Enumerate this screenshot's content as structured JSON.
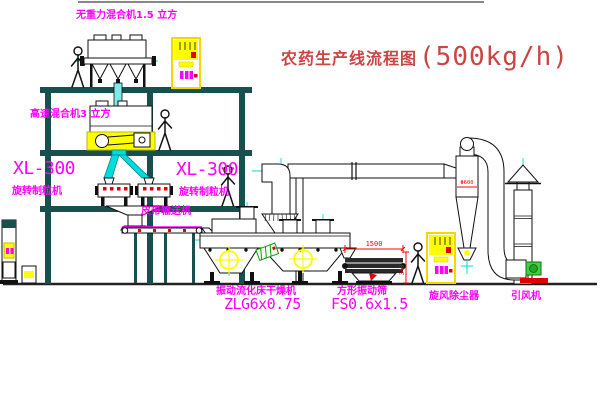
{
  "title": {
    "text": "农药生产线流程图",
    "capacity": "(500kg/h)"
  },
  "labels": {
    "gravity_mixer": "无重力混合机1.5 立方",
    "high_speed_mixer": "高速混合机3 立方",
    "granulator_left": {
      "model": "XL-300",
      "name": "旋转制粒机"
    },
    "granulator_right": {
      "model": "XL-300",
      "name": "旋转制粒机"
    },
    "belt_conveyor": "皮带输送机",
    "dryer": {
      "name": "振动流化床干燥机",
      "model": "ZLG6x0.75"
    },
    "screen": {
      "name": "方形振动筛",
      "model": "FS0.6x1.5"
    },
    "cyclone": "旋风除尘器",
    "fan": "引风机"
  },
  "dimensions": {
    "screen_length": "1500",
    "screen_height": "340",
    "cyclone_diameter": "Φ600"
  },
  "colors": {
    "label_magenta": "#ff00ff",
    "title_red": "#cc4444",
    "dimension_red": "#ff0000",
    "highlight_yellow": "#ffff00",
    "centerline_cyan": "#00dcdc",
    "structure_teal": "#17504f"
  }
}
